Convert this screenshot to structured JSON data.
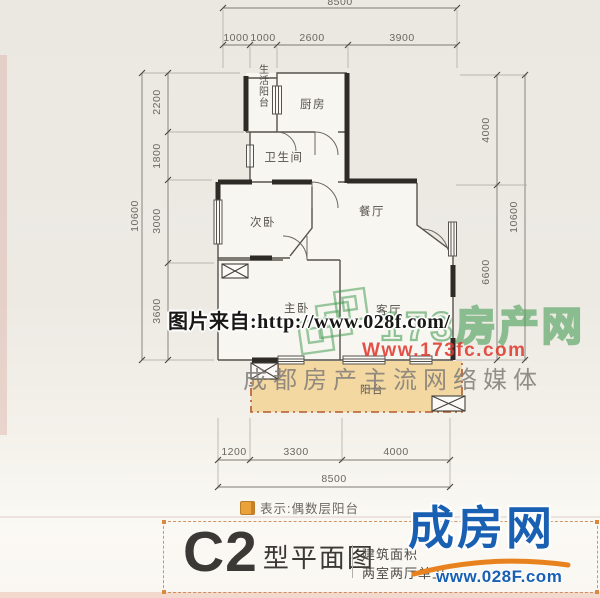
{
  "plan": {
    "rooms": {
      "service_balcony": "生活阳台",
      "kitchen": "厨房",
      "bathroom": "卫生间",
      "secondary_bedroom": "次卧",
      "dining_room": "餐厅",
      "master_bedroom": "主卧",
      "living_room": "客厅",
      "balcony": "阳台"
    },
    "dimensions": {
      "top_total": "8500",
      "top_segments": [
        "1000",
        "1000",
        "2600",
        "3900"
      ],
      "left_total": "10600",
      "left_segments": [
        "2200",
        "1800",
        "3000",
        "3600"
      ],
      "right_total": "10600",
      "right_segments": [
        "4000",
        "6600"
      ],
      "bottom_segments": [
        "1200",
        "3300",
        "4000"
      ],
      "bottom_total": "8500"
    },
    "colors": {
      "balcony_fill": "#f3d8a1",
      "balcony_border": "#b45a2e",
      "wall": "#2e2b27"
    }
  },
  "legend": {
    "text": "表示:偶数层阳台",
    "icon_color": "#eaa33b"
  },
  "watermarks": {
    "photo_credit": "图片来自:http://www.028f.com/",
    "portal_name": "173房产网",
    "portal_url": "Www.173fc.com",
    "portal_slogan": "成都房产主流网络媒体"
  },
  "footer": {
    "plan_code": "C2",
    "plan_label": "型平面图",
    "info_line1": "建筑面积",
    "info_line2": "两室两厅单卫",
    "brand_name": "成房网",
    "brand_url": "www.028F.com",
    "brand_color": "#1960b3",
    "accent_color": "#e8821e"
  }
}
